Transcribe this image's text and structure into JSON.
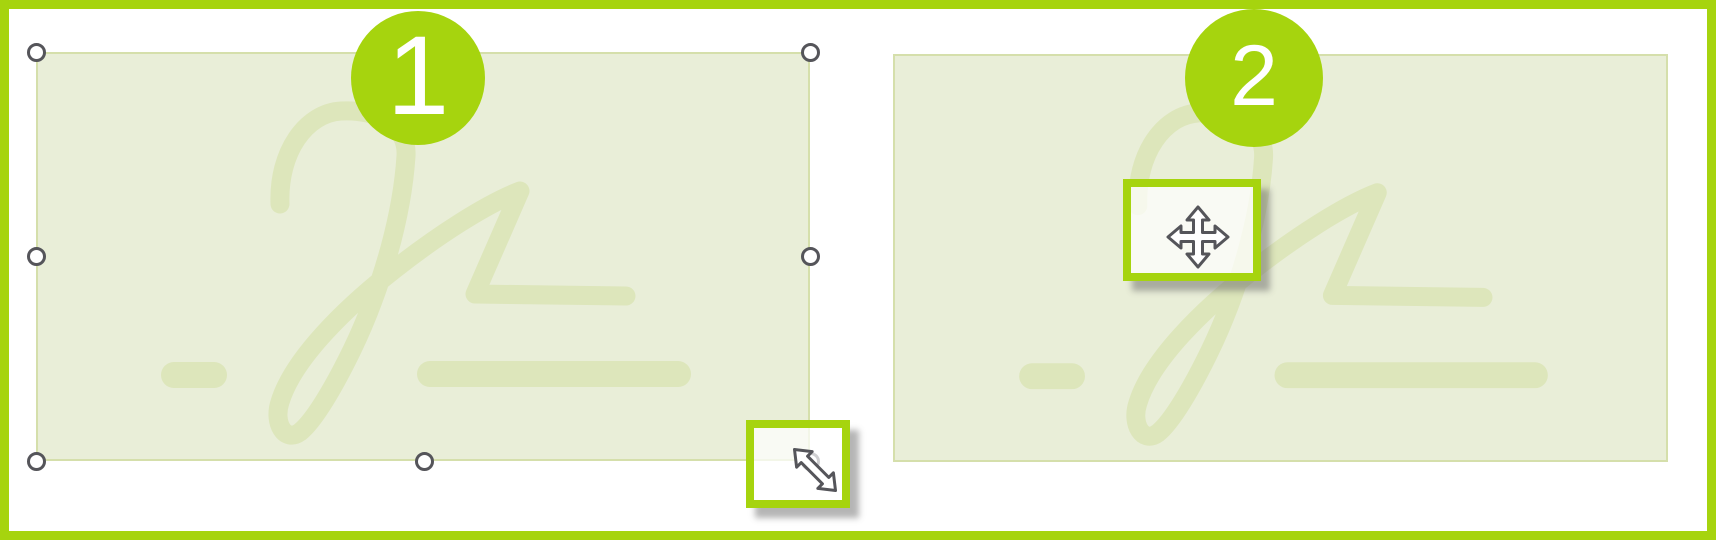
{
  "colors": {
    "accent": "#a6d40e",
    "field-fill": "#e9eed8",
    "field-border": "#d5dfab",
    "signature-stroke": "#dde6bb",
    "handle-ring": "#55555a",
    "cursor-outline": "#55555a"
  },
  "panels": [
    {
      "step_badge": "1",
      "field_name": "signature-placeholder",
      "cursor_icon": "diagonal-resize-cursor",
      "selection_handles": 8
    },
    {
      "step_badge": "2",
      "field_name": "signature-placeholder",
      "cursor_icon": "move-cursor",
      "selection_handles": 0
    }
  ]
}
